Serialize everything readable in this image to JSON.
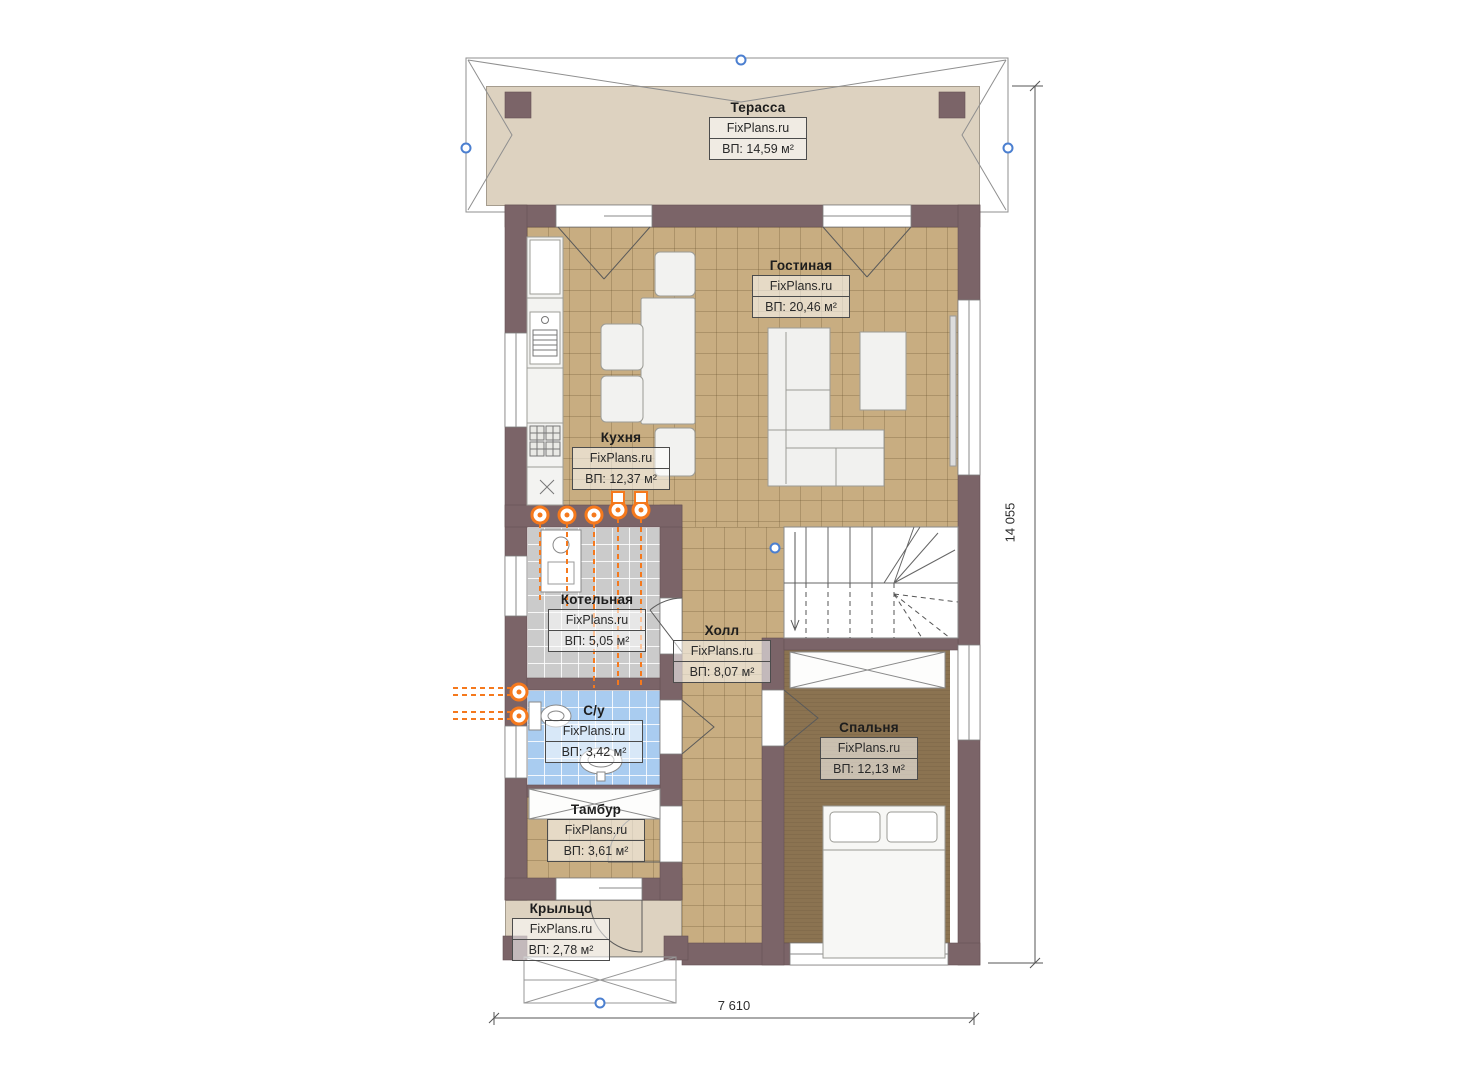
{
  "plan": {
    "title": "floor-plan-first-level",
    "rooms": [
      {
        "id": "terrace",
        "name": "Терасса",
        "site": "FixPlans.ru",
        "area": "ВП: 14,59 м²"
      },
      {
        "id": "living",
        "name": "Гостиная",
        "site": "FixPlans.ru",
        "area": "ВП: 20,46 м²"
      },
      {
        "id": "kitchen",
        "name": "Кухня",
        "site": "FixPlans.ru",
        "area": "ВП: 12,37 м²"
      },
      {
        "id": "boiler",
        "name": "Котельная",
        "site": "FixPlans.ru",
        "area": "ВП: 5,05 м²"
      },
      {
        "id": "hall",
        "name": "Холл",
        "site": "FixPlans.ru",
        "area": "ВП: 8,07 м²"
      },
      {
        "id": "wc",
        "name": "С/у",
        "site": "FixPlans.ru",
        "area": "ВП: 3,42 м²"
      },
      {
        "id": "bedroom",
        "name": "Спальня",
        "site": "FixPlans.ru",
        "area": "ВП: 12,13 м²"
      },
      {
        "id": "tambour",
        "name": "Тамбур",
        "site": "FixPlans.ru",
        "area": "ВП: 3,61 м²"
      },
      {
        "id": "porch",
        "name": "Крыльцо",
        "site": "FixPlans.ru",
        "area": "ВП: 2,78 м²"
      }
    ],
    "dimensions": {
      "height_total": "14 055",
      "width_total": "7 610"
    },
    "colors": {
      "wall": "#7b6468",
      "tile": "#c8ad81",
      "carpet": "#8b7351",
      "bath": "#a9ccf0",
      "boiler": "#cbcbcb",
      "terrace": "#ddd2c0",
      "pipe_orange": "#f5791d",
      "axis_blue": "#4b7fd0"
    }
  }
}
